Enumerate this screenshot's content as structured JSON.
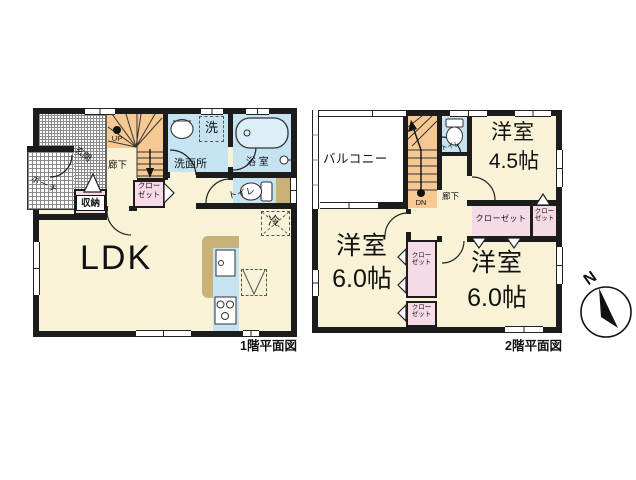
{
  "palette": {
    "floor_cream": "#F8F2D6",
    "stairs_orange": "#F6C992",
    "wet_area_blue": "#C6E3F2",
    "closet_pink": "#F6DAE6",
    "counter_tan": "#C9B277",
    "wall_black": "#1c1c1c"
  },
  "floor1": {
    "caption": "1階平面図",
    "labels": {
      "ldk": "LDK",
      "entrance": "玄関",
      "porch": "ポーチ",
      "storage": "収納",
      "hallway": "廊下",
      "closet_line1": "クロー",
      "closet_line2": "ゼット",
      "washroom": "洗面所",
      "laundry": "洗",
      "bath": "浴 室",
      "toilet": "トイレ",
      "fridge": "冷",
      "up": "UP"
    }
  },
  "floor2": {
    "caption": "2階平面図",
    "labels": {
      "balcony": "バルコニー",
      "hallway": "廊下",
      "toilet": "トイレ",
      "dn": "DN",
      "room_small_name": "洋室",
      "room_small_size": "4.5帖",
      "room_left_name": "洋室",
      "room_left_size": "6.0帖",
      "room_right_name": "洋室",
      "room_right_size": "6.0帖",
      "closet_wide": "クローゼット",
      "closet_line1": "クロー",
      "closet_line2": "ゼット"
    }
  },
  "compass": {
    "north": "N"
  }
}
